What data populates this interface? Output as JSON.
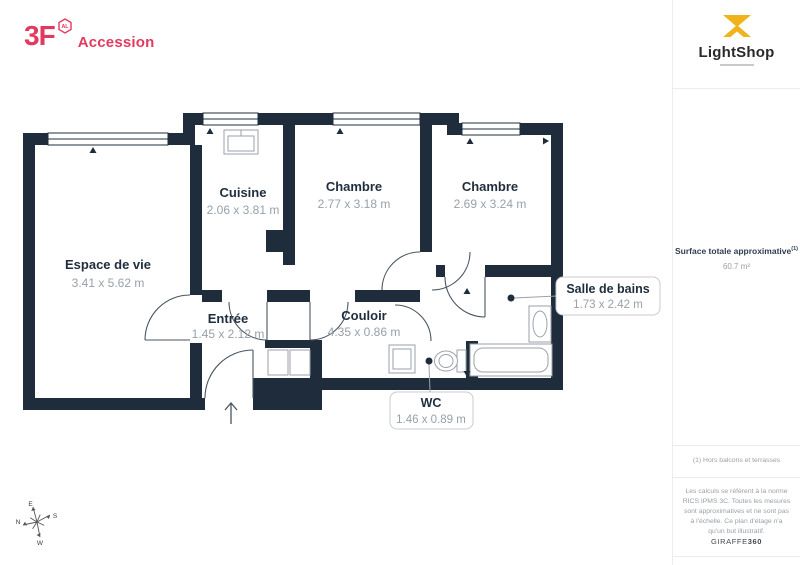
{
  "brand": {
    "name": "3F",
    "badge": "AL",
    "suffix": "Accession"
  },
  "partner": {
    "name": "LightShop"
  },
  "summary": {
    "label": "Surface totale approximative",
    "sup": "(1)",
    "value": "60.7 m²"
  },
  "notes": {
    "footnote": "(1) Hors balcons et terrasses",
    "disclaimer": "Les calculs se réfèrent à la norme RICS IPMS 3C. Toutes les mesures sont approximatives et ne sont pas à l'échelle. Ce plan d'étage n'a qu'un but illustratif.",
    "credit": "GIRAFFE",
    "credit_bold": "360"
  },
  "rooms": {
    "living": {
      "name": "Espace de vie",
      "dims": "3.41 x 5.62 m"
    },
    "kitchen": {
      "name": "Cuisine",
      "dims": "2.06 x 3.81 m"
    },
    "bedroom1": {
      "name": "Chambre",
      "dims": "2.77 x 3.18 m"
    },
    "bedroom2": {
      "name": "Chambre",
      "dims": "2.69 x 3.24 m"
    },
    "entry": {
      "name": "Entrée",
      "dims": "1.45 x 2.12 m"
    },
    "hallway": {
      "name": "Couloir",
      "dims": "4.35 x 0.86 m"
    },
    "bathroom": {
      "name": "Salle de bains",
      "dims": "1.73 x 2.42 m"
    },
    "wc": {
      "name": "WC",
      "dims": "1.46 x 0.89 m"
    }
  },
  "compass": {
    "n": "N",
    "e": "E",
    "s": "S",
    "w": "W"
  },
  "colors": {
    "wall": "#1e2c3c",
    "accent_pink": "#e23a5f",
    "accent_gold": "#f0b41a",
    "room_label": "#1f2d3d",
    "dims_gray": "#98a0a8",
    "divider_gray": "#ececec"
  }
}
